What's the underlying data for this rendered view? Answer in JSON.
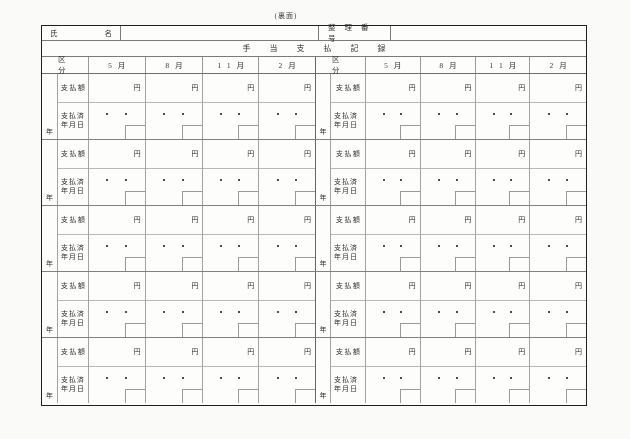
{
  "side_note": "(裏面)",
  "name_row": {
    "label_first": "氏",
    "label_second": "名",
    "name_value": "",
    "serial_label": "整理番号",
    "serial_value": ""
  },
  "title": "手当支払記録",
  "table": {
    "kubun_header": "区分",
    "month_headers": [
      "5月",
      "8月",
      "11月",
      "2月"
    ],
    "labels": {
      "amount": "支払額",
      "paid_date_line1": "支払済",
      "paid_date_line2": "年月日",
      "yen": "円",
      "year": "年"
    },
    "blocks_per_half": 5,
    "halves": 2
  }
}
